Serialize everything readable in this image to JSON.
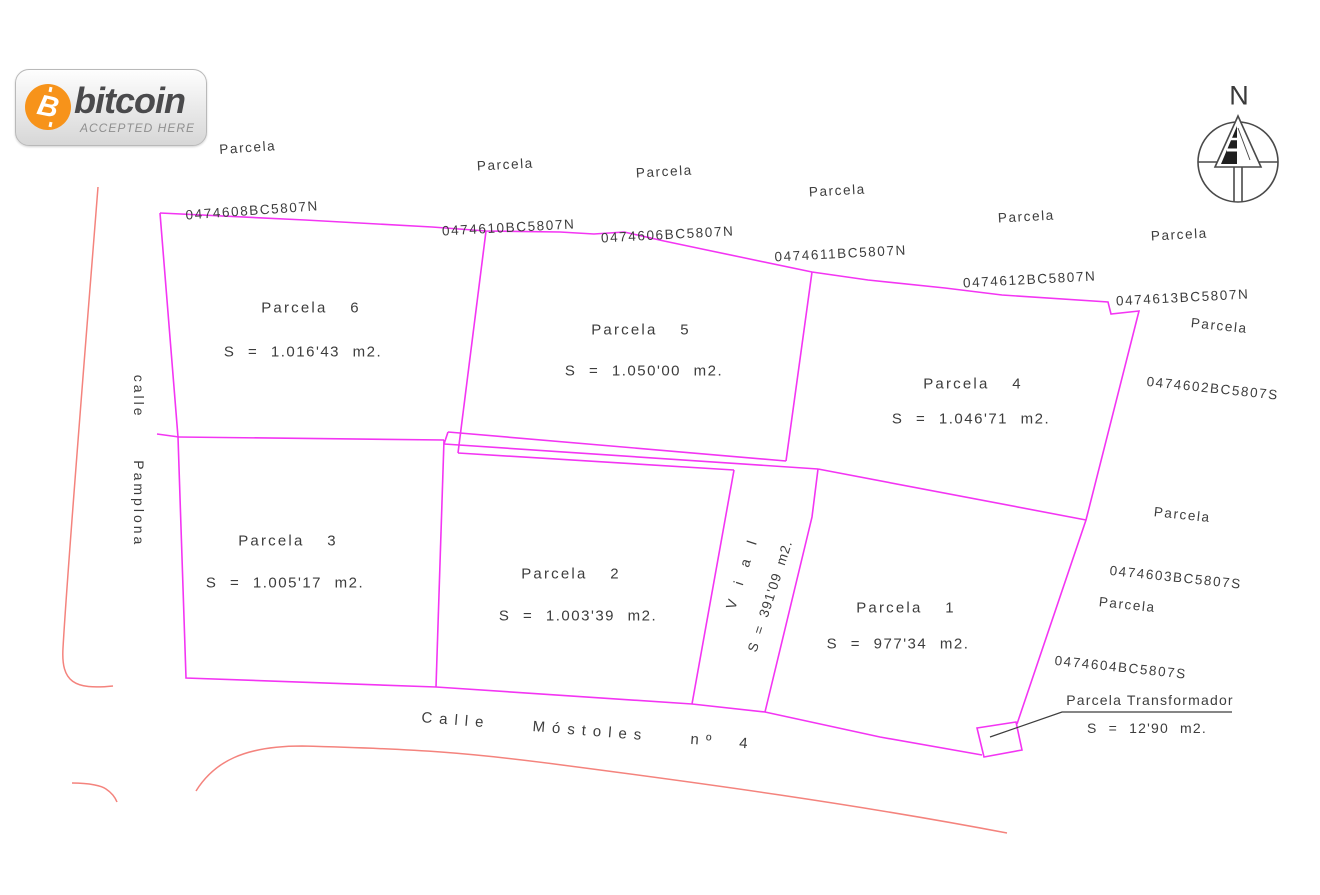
{
  "badge": {
    "brand": "bitcoin",
    "tagline": "ACCEPTED HERE",
    "symbol": "B"
  },
  "compass": {
    "label": "N"
  },
  "streets": {
    "left_vertical": "calle  Pamplona",
    "bottom": "Calle  Móstoles  nº 4"
  },
  "parcels": [
    {
      "name": "Parcela  6",
      "area": "S = 1.016'43 m2."
    },
    {
      "name": "Parcela  5",
      "area": "S = 1.050'00 m2."
    },
    {
      "name": "Parcela  4",
      "area": "S = 1.046'71 m2."
    },
    {
      "name": "Parcela  3",
      "area": "S = 1.005'17 m2."
    },
    {
      "name": "Parcela  2",
      "area": "S = 1.003'39 m2."
    },
    {
      "name": "Parcela  1",
      "area": "S = 977'34 m2."
    }
  ],
  "vial": {
    "name": "V i a l",
    "area": "S = 391'09 m2."
  },
  "transformer": {
    "name": "Parcela Transformador",
    "area": "S = 12'90 m2."
  },
  "cadastral_labels": [
    {
      "line1": "Parcela",
      "line2": "0474608BC5807N"
    },
    {
      "line1": "Parcela",
      "line2": "0474610BC5807N"
    },
    {
      "line1": "Parcela",
      "line2": "0474606BC5807N"
    },
    {
      "line1": "Parcela",
      "line2": "0474611BC5807N"
    },
    {
      "line1": "Parcela",
      "line2": "0474612BC5807N"
    },
    {
      "line1": "Parcela",
      "line2": "0474613BC5807N"
    },
    {
      "line1": "Parcela",
      "line2": "0474602BC5807S"
    },
    {
      "line1": "Parcela",
      "line2": "0474603BC5807S"
    },
    {
      "line1": "Parcela",
      "line2": "0474604BC5807S"
    }
  ],
  "colors": {
    "parcel_line": "#f335f3",
    "street_line": "#f4837d",
    "leader_line": "#3d3d3d",
    "text": "#3d3d3d",
    "bitcoin_orange": "#f7931a"
  }
}
